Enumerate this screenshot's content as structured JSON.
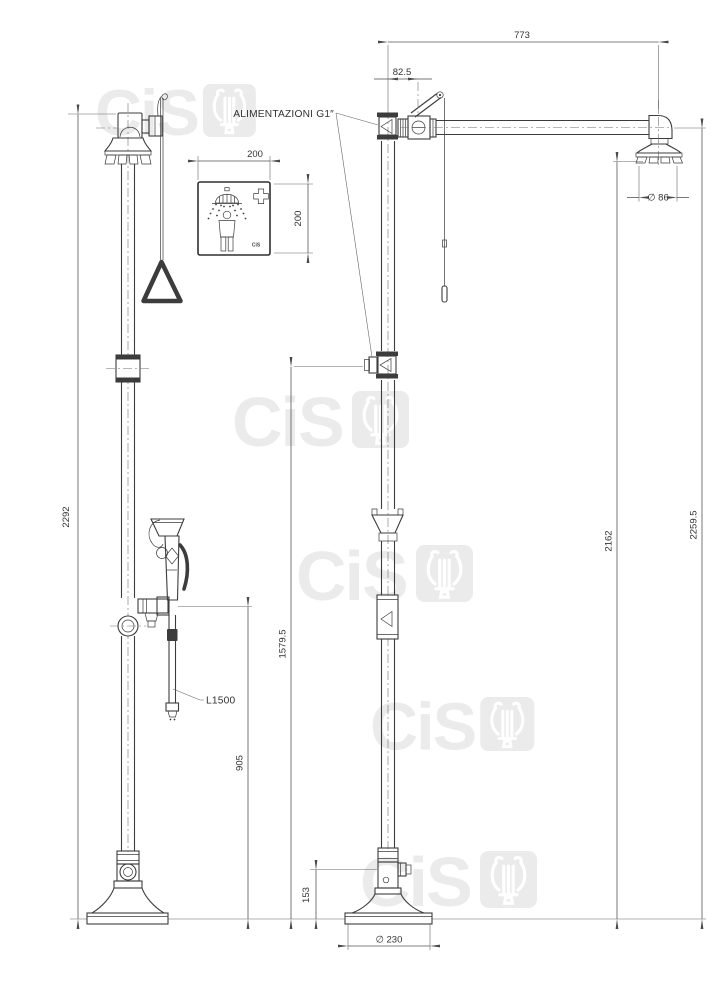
{
  "watermark": {
    "text": "CiS"
  },
  "annotations": {
    "supply_note": "ALIMENTAZIONI G1″",
    "hose_length_label": "L1500"
  },
  "sign": {
    "width_label": "200",
    "height_label": "200",
    "logo_text": "CiS"
  },
  "dimensions": {
    "overall_height_front": "2292",
    "arm_length": "773",
    "valve_offset": "82.5",
    "shower_head_diameter": "∅ 86",
    "shower_outlet_height": "2162",
    "total_height_side": "2259.5",
    "supply_inlet_height": "1579.5",
    "eyewash_outlet_height": "905",
    "base_inlet_height": "153",
    "base_diameter": "∅ 230"
  },
  "colors": {
    "linework": "#3c3c3c",
    "dimension_lines": "#555555",
    "watermark": "#ebebeb"
  }
}
